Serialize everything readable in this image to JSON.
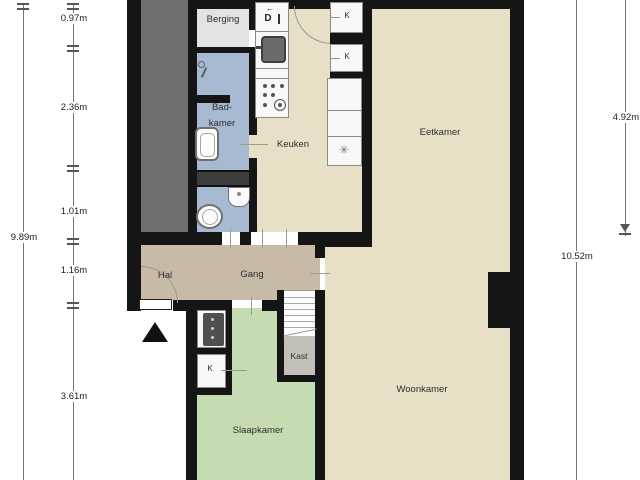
{
  "plan": {
    "type": "floorplan",
    "rooms": {
      "berging": {
        "label": "Berging"
      },
      "badkamer": {
        "label_line1": "Bad-",
        "label_line2": "kamer"
      },
      "keuken": {
        "label": "Keuken"
      },
      "eetkamer": {
        "label": "Eetkamer"
      },
      "hal": {
        "label": "Hal"
      },
      "gang": {
        "label": "Gang"
      },
      "kast": {
        "label": "Kast"
      },
      "slaapkamer": {
        "label": "Slaapkamer"
      },
      "woonkamer": {
        "label": "Woonkamer"
      }
    },
    "closets": {
      "k_top_1": "K",
      "k_top_2": "K",
      "k_bottom": "K"
    },
    "appliances": {
      "dishwasher_label": "D"
    },
    "icons": {
      "appliance_arrow": "←",
      "freezer": "✳"
    },
    "dimensions": {
      "left_total": "9.89m",
      "left_segments": [
        "0.97m",
        "2.36m",
        "1.01m",
        "1.16m",
        "3.61m"
      ],
      "right_upper": "4.92m",
      "right_total": "10.52m"
    },
    "colors": {
      "wall": "#151515",
      "living_beige": "#e7e0c6",
      "corridor_tan": "#c7bba8",
      "bedroom_green": "#c5dcb2",
      "bathroom_blue": "#a8bad1",
      "berging_gray": "#e3e3e1",
      "shaft_gray": "#6f6f6f",
      "kast_gray": "#c2c0b8"
    }
  }
}
